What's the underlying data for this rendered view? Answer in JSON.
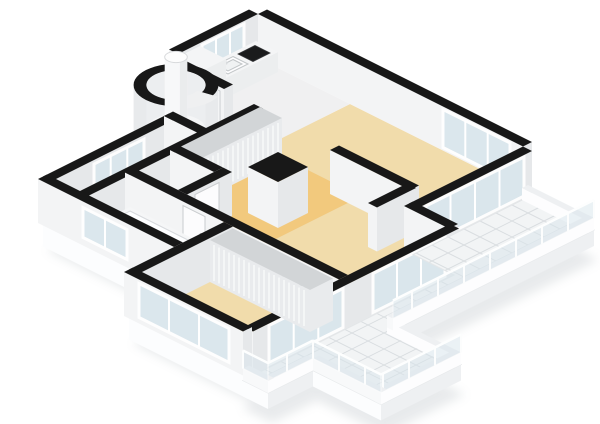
{
  "view": {
    "title": "3d-floorplan-render",
    "width": 600,
    "height": 424,
    "background": "#ffffff"
  },
  "palette": {
    "black": "#181818",
    "wallSE": "#e6e8ea",
    "wallSW": "#f3f4f5",
    "white": "#fdfdfe",
    "counterTop": "#f4f5f6",
    "counterFace": "#eceeef",
    "floorLiving": "#f1dcab",
    "floorHall": "#f2c97d",
    "floorKitchen": "#f0f0f1",
    "floorVest": "#eff0f1",
    "floorStorage": "#41464b",
    "floorBath": "#dce8ef",
    "floorTurret": "#f4f5f6",
    "tile": "#f2f4f5",
    "tileLine": "#d9dde0",
    "glass": "#d9e6ed",
    "parapetTop": "#eef0f2",
    "shadow": "#cdd2d6"
  },
  "rooms": [
    {
      "name": "kitchen",
      "floor": "white"
    },
    {
      "name": "living-room",
      "floor": "beige"
    },
    {
      "name": "hallway",
      "floor": "orange-beige"
    },
    {
      "name": "vestibule",
      "floor": "white"
    },
    {
      "name": "storage-room",
      "floor": "dark-gray"
    },
    {
      "name": "toilet-room",
      "floor": "light-blue"
    },
    {
      "name": "bathroom",
      "floor": "light-blue"
    },
    {
      "name": "bedroom",
      "floor": "beige"
    },
    {
      "name": "turret",
      "floor": "white"
    },
    {
      "name": "balcony-terrace",
      "floor": "white-tiles"
    }
  ],
  "fixtures": [
    "kitchen-counter",
    "kitchen-sink",
    "cooktop",
    "refrigerator",
    "chimney",
    "hall-closet",
    "bedroom-closet",
    "bathtub",
    "toilet-wc",
    "toilet-bathroom",
    "column"
  ],
  "scene": {
    "origin": [
      258,
      58
    ],
    "wall_height": 44,
    "primitives": [
      {
        "t": "shadow",
        "name": "ground-shadow",
        "pts": [
          [
            0,
            0
          ],
          [
            265,
            0
          ],
          [
            340,
            4
          ],
          [
            340,
            205
          ],
          [
            408,
            205
          ],
          [
            408,
            285
          ],
          [
            340,
            285
          ],
          [
            340,
            330
          ],
          [
            310,
            330
          ],
          [
            310,
            320
          ],
          [
            191,
            320
          ],
          [
            191,
            270
          ],
          [
            55,
            270
          ],
          [
            55,
            144
          ],
          [
            0,
            80
          ]
        ]
      },
      {
        "t": "slab",
        "name": "floor-slab",
        "dep": 26,
        "edges": [
          {
            "p": "b",
            "at": 114,
            "f0": 265,
            "f1": 310
          },
          {
            "p": "a",
            "at": 310,
            "f0": 114,
            "f1": 320
          },
          {
            "p": "b",
            "at": 320,
            "f0": 191,
            "f1": 310
          },
          {
            "p": "b",
            "at": 270,
            "f0": 55,
            "f1": 191
          }
        ]
      },
      {
        "t": "floor",
        "name": "living-room-floor",
        "fill": "floorLiving",
        "pts": [
          [
            92,
            0
          ],
          [
            265,
            0
          ],
          [
            265,
            114
          ],
          [
            310,
            114
          ],
          [
            310,
            216
          ],
          [
            190,
            216
          ],
          [
            190,
            87
          ],
          [
            92,
            87
          ]
        ]
      },
      {
        "t": "floor",
        "name": "hallway-floor",
        "fill": "floorHall",
        "pts": [
          [
            92,
            87
          ],
          [
            190,
            87
          ],
          [
            190,
            216
          ],
          [
            92,
            216
          ]
        ]
      },
      {
        "t": "floor",
        "name": "kitchen-floor",
        "fill": "floorKitchen",
        "pts": [
          [
            0,
            0
          ],
          [
            92,
            0
          ],
          [
            92,
            83
          ],
          [
            0,
            83
          ]
        ]
      },
      {
        "t": "floor",
        "name": "vestibule-floor",
        "fill": "floorVest",
        "pts": [
          [
            55,
            92
          ],
          [
            88,
            92
          ],
          [
            88,
            140
          ],
          [
            55,
            140
          ]
        ]
      },
      {
        "t": "floor",
        "name": "storage-floor",
        "fill": "floorStorage",
        "pts": [
          [
            55,
            149
          ],
          [
            88,
            149
          ],
          [
            88,
            266
          ],
          [
            55,
            266
          ]
        ]
      },
      {
        "t": "floor",
        "name": "toilet-floor",
        "fill": "floorBath",
        "pts": [
          [
            92,
            180
          ],
          [
            136,
            180
          ],
          [
            136,
            216
          ],
          [
            92,
            216
          ]
        ]
      },
      {
        "t": "floor",
        "name": "bathroom-floor",
        "fill": "floorBath",
        "pts": [
          [
            92,
            225
          ],
          [
            191,
            225
          ],
          [
            191,
            266
          ],
          [
            92,
            266
          ]
        ]
      },
      {
        "t": "floor",
        "name": "bedroom-floor",
        "fill": "floorLiving",
        "pts": [
          [
            195,
            225
          ],
          [
            306,
            225
          ],
          [
            306,
            316
          ],
          [
            195,
            316
          ]
        ]
      },
      {
        "t": "wall",
        "name": "exterior-wall-ne",
        "a0": 0,
        "a1": 265,
        "b0": -9,
        "b1": 0
      },
      {
        "t": "glass",
        "name": "window-ne",
        "plane": "b",
        "at": 0,
        "f0": 185,
        "f1": 252,
        "z0": 3,
        "z1": 41,
        "m": 2
      },
      {
        "t": "wall",
        "name": "exterior-wall-nw-upper",
        "a0": -9,
        "a1": 0,
        "b0": 0,
        "b1": 80
      },
      {
        "t": "glass",
        "name": "window-kitchen",
        "plane": "a",
        "at": 0,
        "f0": 14,
        "f1": 56,
        "z0": 3,
        "z1": 41,
        "m": 2
      },
      {
        "t": "box",
        "name": "kitchen-counter",
        "a0": 2,
        "a1": 24,
        "b0": 4,
        "b1": 60,
        "h": 20,
        "ftop": "counterTop",
        "fse": "counterFace",
        "fsw": "white"
      },
      {
        "t": "sink",
        "name": "kitchen-sink",
        "a0": 6,
        "a1": 21,
        "b0": 31,
        "b1": 51,
        "z": 20
      },
      {
        "t": "cooktop",
        "name": "cooktop",
        "a0": 6,
        "a1": 21,
        "b0": 9,
        "b1": 26,
        "z": 20
      },
      {
        "t": "box",
        "name": "refrigerator",
        "a0": 2,
        "a1": 28,
        "b0": 60,
        "b1": 82,
        "h": 43,
        "ftop": "counterTop",
        "fse": "counterFace",
        "fsw": "white"
      },
      {
        "t": "wall",
        "name": "wall-kitchen-hall",
        "a0": 0,
        "a1": 58,
        "b0": 83,
        "b1": 92
      },
      {
        "t": "door",
        "name": "door-kitchen",
        "plane": "b",
        "at": 92,
        "f0": 34,
        "f1": 54
      },
      {
        "t": "turret",
        "name": "turret",
        "ca": 30,
        "cb": 112,
        "r": 30,
        "h": 44
      },
      {
        "t": "cyl",
        "name": "chimney",
        "ca": 30,
        "cb": 112,
        "r": 8,
        "h": 72
      },
      {
        "t": "wall",
        "name": "exterior-wall-nw-mid",
        "a0": 55,
        "a1": 64,
        "b0": 144,
        "b1": 270
      },
      {
        "t": "glass",
        "name": "window-storage",
        "plane": "a",
        "at": 64,
        "f0": 178,
        "f1": 228,
        "z0": 6,
        "z1": 40,
        "m": 2
      },
      {
        "t": "wall",
        "name": "wall-vestibule-storage",
        "a0": 55,
        "a1": 92,
        "b0": 140,
        "b1": 149
      },
      {
        "t": "wall",
        "name": "wall-hall-storage",
        "a0": 88,
        "a1": 97,
        "b0": 92,
        "b1": 270
      },
      {
        "t": "door",
        "name": "door-storage",
        "plane": "a",
        "at": 97,
        "f0": 102,
        "f1": 126
      },
      {
        "t": "louver",
        "name": "hall-closet",
        "a0": 92,
        "a1": 114,
        "b0": 90,
        "b1": 170,
        "h": 42,
        "face": "a"
      },
      {
        "t": "wall",
        "name": "wall-toilet-nw",
        "a0": 92,
        "a1": 136,
        "b0": 171,
        "b1": 180
      },
      {
        "t": "toilet",
        "name": "toilet-wc",
        "ca": 112,
        "cb": 196
      },
      {
        "t": "wall",
        "name": "wall-toilet-se",
        "a0": 136,
        "a1": 145,
        "b0": 171,
        "b1": 216
      },
      {
        "t": "door",
        "name": "door-toilet",
        "plane": "a",
        "at": 145,
        "f0": 184,
        "f1": 208
      },
      {
        "t": "wall",
        "name": "wall-living-divider",
        "a0": 172,
        "a1": 252,
        "b0": 91,
        "b1": 100
      },
      {
        "t": "wall",
        "name": "wall-living-divider-leg",
        "a0": 244,
        "a1": 253,
        "b0": 95,
        "b1": 134
      },
      {
        "t": "wall",
        "name": "column",
        "a0": 150,
        "a1": 180,
        "b0": 130,
        "b1": 160,
        "h": 46
      },
      {
        "t": "wall",
        "name": "wall-hall-bedroom",
        "a0": 92,
        "a1": 306,
        "b0": 216,
        "b1": 225
      },
      {
        "t": "door",
        "name": "door-bathroom",
        "plane": "b",
        "at": 225,
        "f0": 150,
        "f1": 172
      },
      {
        "t": "door",
        "name": "door-bedroom",
        "plane": "b",
        "at": 225,
        "f0": 250,
        "f1": 272
      },
      {
        "t": "tub",
        "name": "bathtub",
        "a0": 100,
        "a1": 185,
        "b0": 228,
        "b1": 252,
        "h": 15
      },
      {
        "t": "toilet",
        "name": "toilet-bathroom",
        "ca": 172,
        "cb": 260
      },
      {
        "t": "wall",
        "name": "wall-living-se",
        "a0": 265,
        "a1": 274,
        "b0": 0,
        "b1": 114
      },
      {
        "t": "glass",
        "name": "glass-doors-living",
        "plane": "a",
        "at": 274,
        "f0": 8,
        "f1": 106,
        "z0": 3,
        "z1": 42,
        "m": 3
      },
      {
        "t": "wall",
        "name": "wall-step",
        "a0": 265,
        "a1": 310,
        "b0": 110,
        "b1": 119
      },
      {
        "t": "wall",
        "name": "wall-se-lower",
        "a0": 306,
        "a1": 315,
        "b0": 114,
        "b1": 320
      },
      {
        "t": "glass",
        "name": "glass-doors-dining",
        "plane": "a",
        "at": 315,
        "f0": 128,
        "f1": 200,
        "z0": 3,
        "z1": 42,
        "m": 2
      },
      {
        "t": "glass",
        "name": "glass-doors-bedroom",
        "plane": "a",
        "at": 315,
        "f0": 230,
        "f1": 304,
        "z0": 3,
        "z1": 42,
        "m": 2
      },
      {
        "t": "wall",
        "name": "exterior-wall-sw-bathroom",
        "a0": 55,
        "a1": 191,
        "b0": 266,
        "b1": 275
      },
      {
        "t": "glass",
        "name": "window-bathroom",
        "plane": "b",
        "at": 275,
        "f0": 100,
        "f1": 144,
        "z0": 8,
        "z1": 38,
        "m": 1
      },
      {
        "t": "wall",
        "name": "wall-bathroom-bedroom",
        "a0": 191,
        "a1": 200,
        "b0": 225,
        "b1": 320
      },
      {
        "t": "louver",
        "name": "bedroom-closet",
        "a0": 200,
        "a1": 300,
        "b0": 225,
        "b1": 248,
        "h": 42,
        "face": "b"
      },
      {
        "t": "wall",
        "name": "exterior-wall-sw-bedroom",
        "a0": 191,
        "a1": 310,
        "b0": 316,
        "b1": 325
      },
      {
        "t": "glass",
        "name": "window-bedroom",
        "plane": "b",
        "at": 325,
        "f0": 206,
        "f1": 296,
        "z0": 6,
        "z1": 40,
        "m": 2
      },
      {
        "t": "slab",
        "name": "balcony-slab",
        "dep": 16,
        "edges": [
          {
            "p": "a",
            "at": 340,
            "f0": 4,
            "f1": 205
          },
          {
            "p": "a",
            "at": 408,
            "f0": 205,
            "f1": 285
          },
          {
            "p": "b",
            "at": 285,
            "f0": 340,
            "f1": 408
          },
          {
            "p": "a",
            "at": 340,
            "f0": 285,
            "f1": 330
          },
          {
            "p": "b",
            "at": 330,
            "f0": 315,
            "f1": 340
          }
        ]
      },
      {
        "t": "tiles",
        "name": "balcony-floor",
        "step": 16,
        "pts": [
          [
            274,
            4
          ],
          [
            340,
            4
          ],
          [
            340,
            205
          ],
          [
            408,
            205
          ],
          [
            408,
            285
          ],
          [
            340,
            285
          ],
          [
            340,
            330
          ],
          [
            315,
            330
          ],
          [
            315,
            119
          ],
          [
            274,
            119
          ]
        ]
      },
      {
        "t": "box",
        "name": "balcony-parapet-ne",
        "a0": 274,
        "a1": 340,
        "b0": 4,
        "b1": 10,
        "h": 12,
        "ftop": "parapetTop",
        "fse": "white",
        "fsw": "white"
      },
      {
        "t": "box",
        "name": "balcony-parapet-e",
        "a0": 340,
        "a1": 408,
        "b0": 205,
        "b1": 211,
        "h": 12,
        "ftop": "parapetTop",
        "fse": "white",
        "fsw": "white"
      },
      {
        "t": "rail",
        "name": "balcony-rail-1",
        "plane": "a",
        "at": 340,
        "f0": 4,
        "f1": 205
      },
      {
        "t": "rail",
        "name": "balcony-rail-2",
        "plane": "a",
        "at": 408,
        "f0": 205,
        "f1": 285
      },
      {
        "t": "rail",
        "name": "balcony-rail-3",
        "plane": "b",
        "at": 285,
        "f0": 340,
        "f1": 408
      },
      {
        "t": "rail",
        "name": "balcony-rail-4",
        "plane": "a",
        "at": 340,
        "f0": 285,
        "f1": 330
      },
      {
        "t": "rail",
        "name": "balcony-rail-5",
        "plane": "b",
        "at": 330,
        "f0": 315,
        "f1": 340
      }
    ]
  }
}
